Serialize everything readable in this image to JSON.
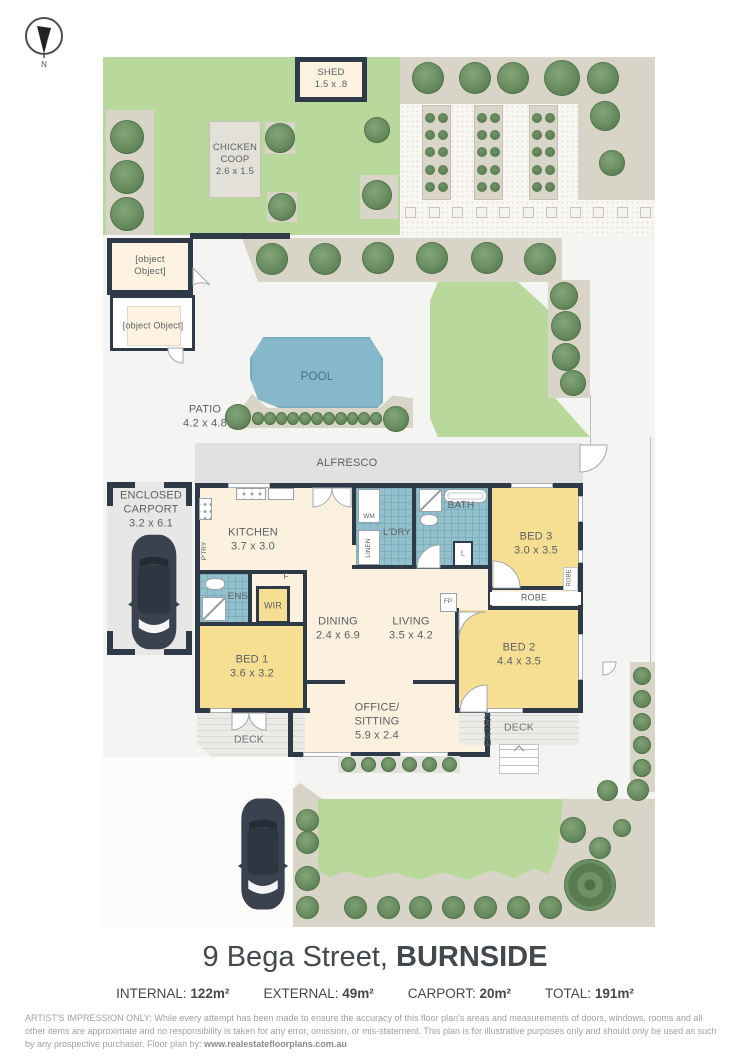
{
  "compass": {
    "north": "N"
  },
  "outbuildings": {
    "shed": {
      "name": "SHED",
      "dims": "1.5 x .8"
    },
    "chicken_coop": {
      "name": "CHICKEN COOP",
      "dims": "2.6 x 1.5"
    },
    "pump_house": {
      "name": "PUMP HOUSE/ STORE"
    },
    "workshop": {
      "name": "SHED/ WORKSHOP"
    }
  },
  "outdoor": {
    "pool": "POOL",
    "patio": {
      "name": "PATIO",
      "dims": "4.2 x 4.8"
    },
    "alfresco": "ALFRESCO",
    "deck_left": "DECK",
    "deck_right": "DECK",
    "entry": "ENTRY"
  },
  "rooms": {
    "carport": {
      "name": "ENCLOSED CARPORT",
      "dims": "3.2 x 6.1"
    },
    "kitchen": {
      "name": "KITCHEN",
      "dims": "3.7 x 3.0"
    },
    "dining": {
      "name": "DINING",
      "dims": "2.4 x 6.9"
    },
    "living": {
      "name": "LIVING",
      "dims": "3.5 x 4.2"
    },
    "office": {
      "name": "OFFICE/ SITTING",
      "dims": "5.9 x 2.4"
    },
    "bed1": {
      "name": "BED 1",
      "dims": "3.6 x 3.2"
    },
    "bed2": {
      "name": "BED 2",
      "dims": "4.4 x 3.5"
    },
    "bed3": {
      "name": "BED 3",
      "dims": "3.0 x 3.5"
    },
    "bath": "BATH",
    "ens": "ENS",
    "wir": "WIR",
    "laundry": "L'DRY",
    "wm": "WM",
    "linen": "LINEN",
    "linen_small": "L",
    "pantry": "P'TRY",
    "fridge": "F",
    "fireplace": "FP",
    "robe_bed2": "ROBE",
    "robe_bed3": "ROBE"
  },
  "footer": {
    "address_street": "9 Bega Street, ",
    "address_suburb": "BURNSIDE",
    "stats": [
      {
        "label": "INTERNAL:",
        "value": "122m²"
      },
      {
        "label": "EXTERNAL:",
        "value": "49m²"
      },
      {
        "label": "CARPORT:",
        "value": "20m²"
      },
      {
        "label": "TOTAL:",
        "value": "191m²"
      }
    ],
    "disclaimer_prefix": "ARTIST'S IMPRESSION ONLY:",
    "disclaimer_body": " While every attempt has been made to ensure the accuracy of this floor plan's areas and measurements of doors, windows, rooms and all other items are approximate and no responsibility is taken for any error, omission, or mis-statement. This plan is for illustrative purposes only and should only be used as such by any prospective purchaser. Floor plan by: ",
    "disclaimer_link": "www.realestatefloorplans.com.au"
  }
}
